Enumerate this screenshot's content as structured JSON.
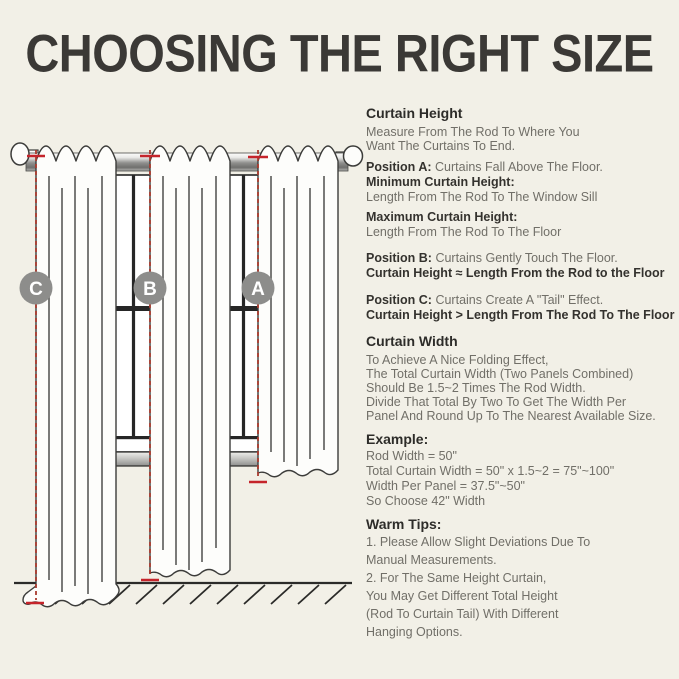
{
  "title": "CHOOSING THE RIGHT SIZE",
  "colors": {
    "background": "#f2f0e7",
    "title_text": "#3b3936",
    "heading_text": "#2d2c29",
    "body_text": "#716f68",
    "measure_tick_red": "#c5242b",
    "measure_dash_red": "#a83a2e",
    "badge_gray": "#8d8d8b",
    "outline_dark": "#3c3c3a"
  },
  "illustration": {
    "badges": [
      {
        "id": "badge-c",
        "label": "C"
      },
      {
        "id": "badge-b",
        "label": "B"
      },
      {
        "id": "badge-a",
        "label": "A"
      }
    ]
  },
  "sections": {
    "curtain_height": {
      "heading": "Curtain Height",
      "lines": [
        "Measure From The Rod To Where You",
        "Want The Curtains To End."
      ]
    },
    "position_a": {
      "label": "Position A:",
      "desc": "Curtains Fall Above The Floor.",
      "min_heading": "Minimum Curtain Height:",
      "min_text": "Length From The Rod To The Window Sill",
      "max_heading": "Maximum Curtain Height:",
      "max_text": "Length From The Rod To The Floor"
    },
    "position_b": {
      "label": "Position B:",
      "desc": "Curtains Gently Touch The Floor.",
      "formula": "Curtain Height ≈ Length From the Rod to the Floor"
    },
    "position_c": {
      "label": "Position C:",
      "desc": "Curtains Create A \"Tail\" Effect.",
      "formula": "Curtain Height > Length From The Rod To The Floor"
    },
    "curtain_width": {
      "heading": "Curtain Width",
      "lines": [
        "To Achieve A Nice Folding Effect,",
        "The Total Curtain Width (Two Panels Combined)",
        "Should Be 1.5~2 Times The Rod Width.",
        "Divide That Total By Two To Get The Width Per",
        "Panel And Round Up To The Nearest Available Size."
      ]
    },
    "example": {
      "heading": "Example:",
      "lines": [
        "Rod Width = 50\"",
        "Total Curtain Width = 50\" x 1.5~2 = 75\"~100\"",
        "Width Per Panel = 37.5\"~50\"",
        "So Choose 42\" Width"
      ]
    },
    "warm_tips": {
      "heading": "Warm Tips:",
      "lines": [
        "1. Please Allow Slight Deviations Due To",
        "Manual Measurements.",
        "2. For The Same Height Curtain,",
        "You May Get Different Total Height",
        "(Rod To Curtain Tail) With Different",
        "Hanging Options."
      ]
    }
  }
}
